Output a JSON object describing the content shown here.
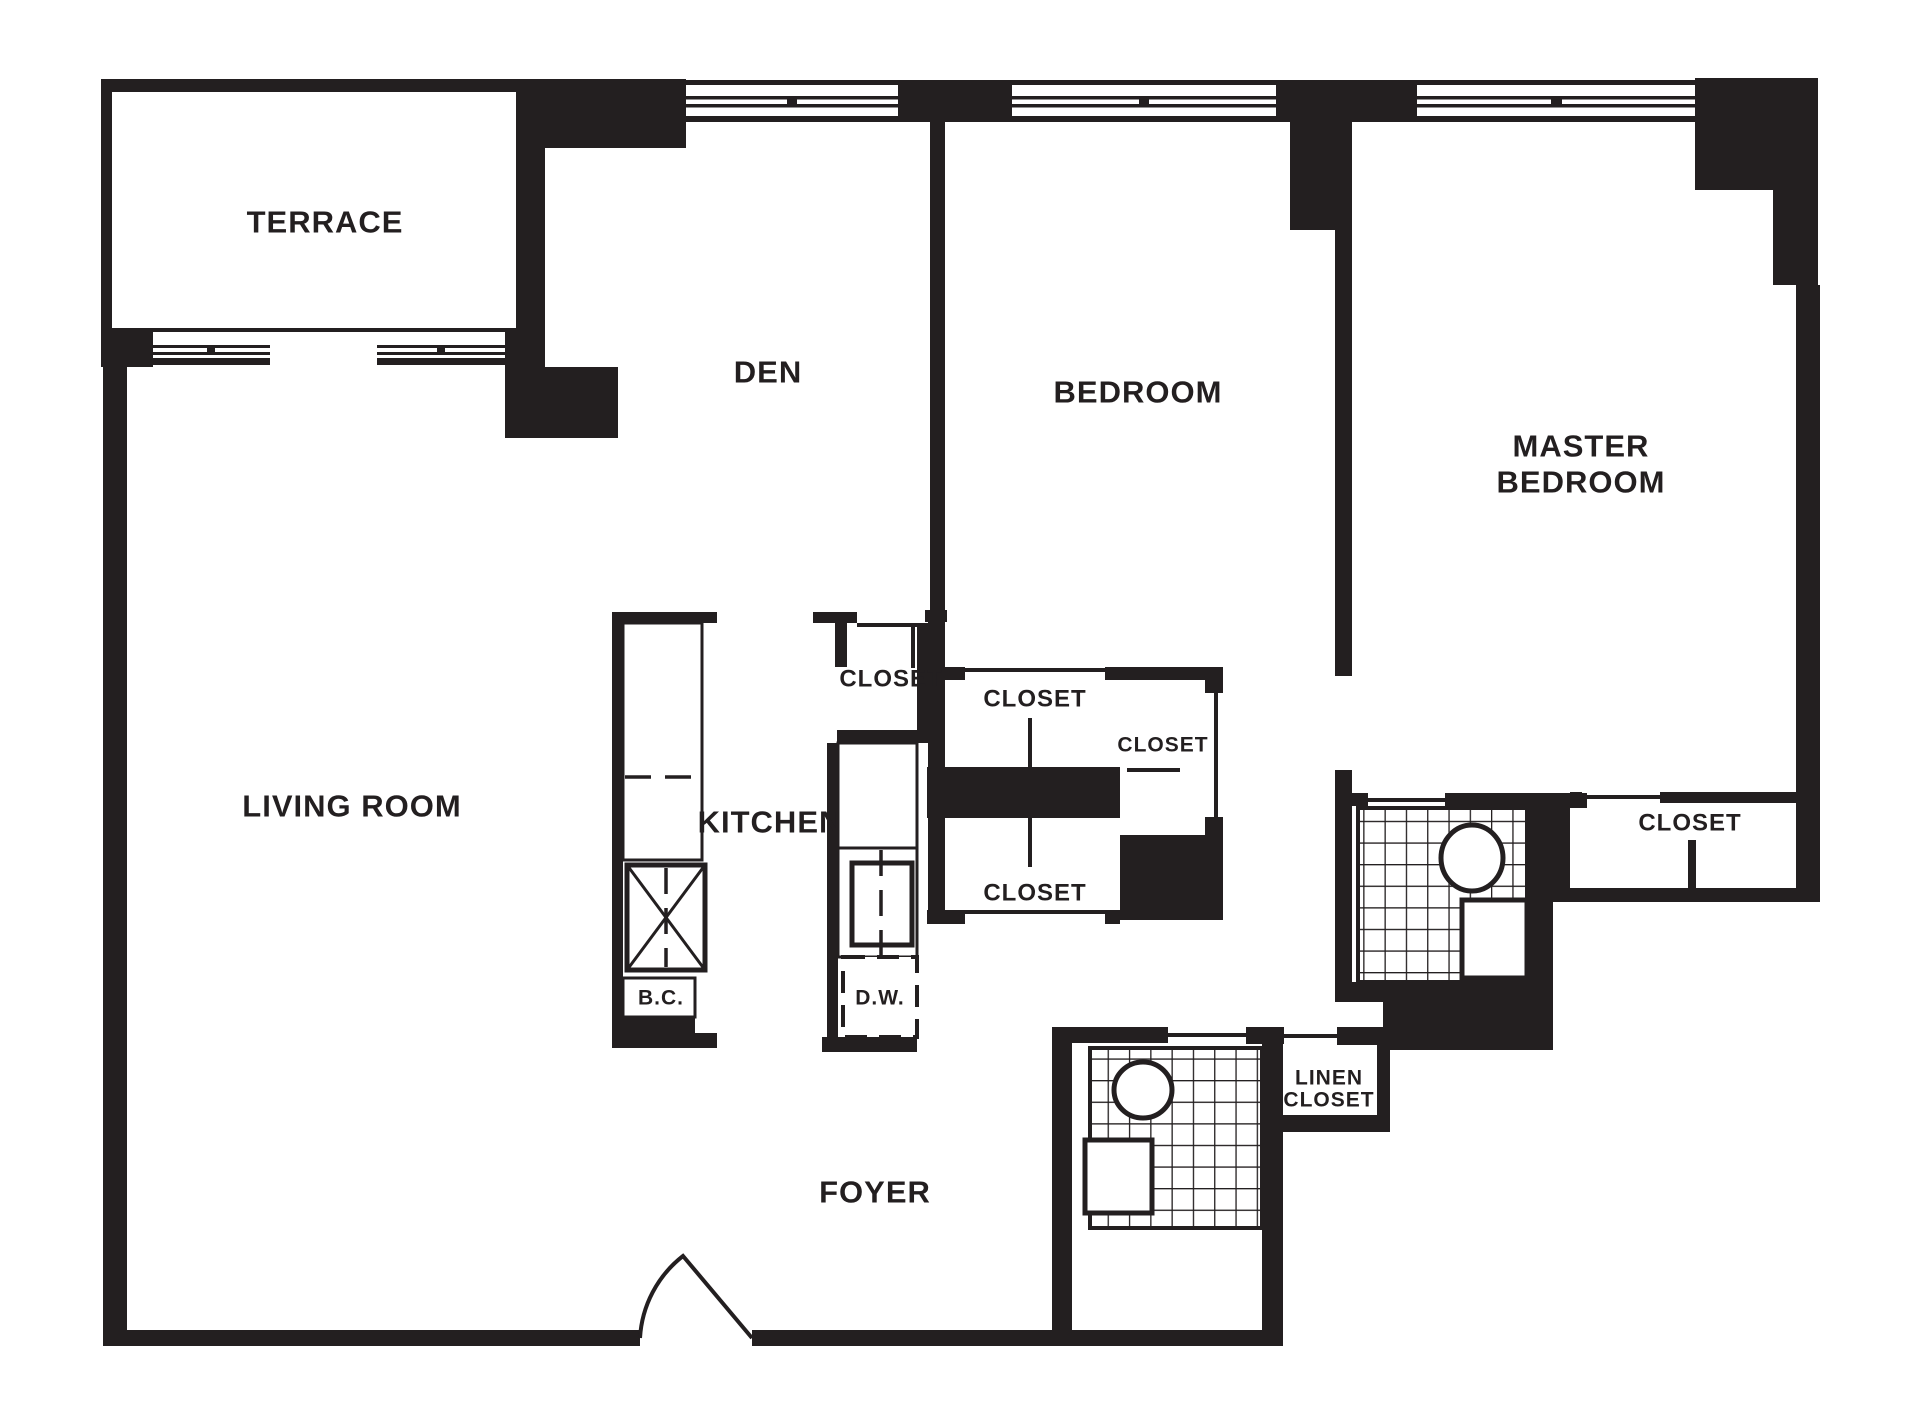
{
  "page": {
    "type": "apartment-floor-plan",
    "background_color": "#ffffff",
    "ink_color": "#231f20"
  },
  "rooms": {
    "terrace": {
      "label": "TERRACE"
    },
    "den": {
      "label": "DEN"
    },
    "bedroom": {
      "label": "BEDROOM"
    },
    "master_bedroom": {
      "label_line1": "MASTER",
      "label_line2": "BEDROOM"
    },
    "living_room": {
      "label": "LIVING ROOM"
    },
    "kitchen": {
      "label": "KITCHEN"
    },
    "foyer": {
      "label": "FOYER"
    }
  },
  "closets": {
    "den_closet": {
      "label": "CLOSET"
    },
    "bedroom_closet": {
      "label": "CLOSET"
    },
    "bedroom_side_closet": {
      "label": "CLOSET"
    },
    "hall_closet": {
      "label": "CLOSET"
    },
    "master_closet": {
      "label": "CLOSET"
    },
    "linen_closet": {
      "label_line1": "LINEN",
      "label_line2": "CLOSET"
    }
  },
  "fixtures": {
    "broom_closet": {
      "label": "B.C."
    },
    "dishwasher": {
      "label": "D.W."
    }
  }
}
